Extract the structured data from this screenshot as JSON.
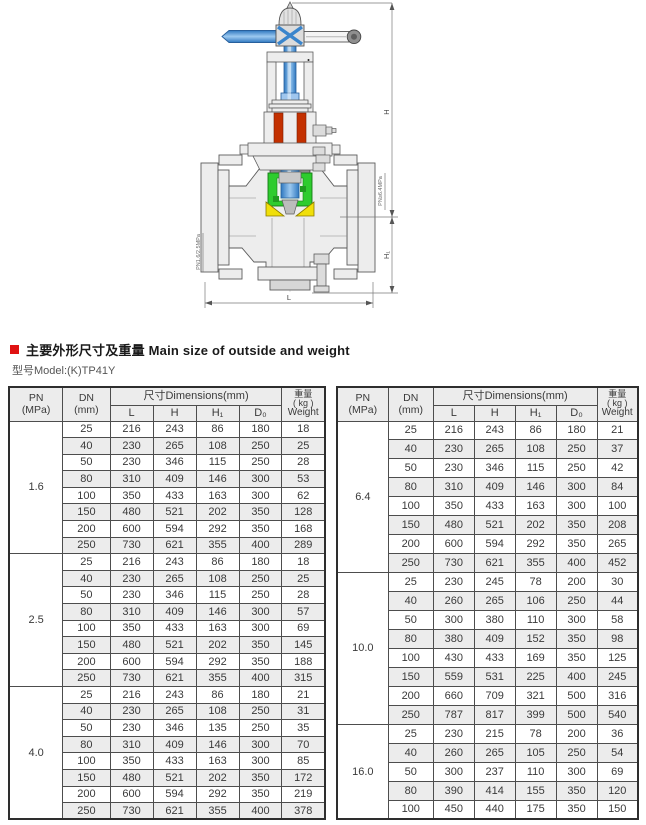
{
  "section": {
    "title_zh": "主要外形尺寸及重量",
    "title_en": "Main size of outside and weight",
    "model": "型号Model:(K)TP41Y"
  },
  "diagram": {
    "labels": {
      "h": "H",
      "h1": "H₁",
      "l": "L",
      "pn_left": "PN1.6/2.5MPa",
      "pn_right": "PN≥6.4MPa"
    },
    "colors": {
      "stem_blue": "#4a90d6",
      "cage_green": "#2ecc2e",
      "seat_yellow": "#f0df0a",
      "packing_red": "#c33000",
      "metal_gray": "#ededed"
    }
  },
  "table_headers": {
    "pn_1": "PN",
    "pn_2": "(MPa)",
    "dn_1": "DN",
    "dn_2": "(mm)",
    "dims": "尺寸Dimensions(mm)",
    "col_l": "L",
    "col_h": "H",
    "col_h1": "H₁",
    "col_d0": "D₀",
    "weight_1": "重量",
    "weight_2": "( kg )",
    "weight_3": "Weight"
  },
  "tables": [
    {
      "groups": [
        {
          "pn": "1.6",
          "rows": [
            [
              25,
              216,
              243,
              86,
              180,
              18
            ],
            [
              40,
              230,
              265,
              108,
              250,
              25
            ],
            [
              50,
              230,
              346,
              115,
              250,
              28
            ],
            [
              80,
              310,
              409,
              146,
              300,
              53
            ],
            [
              100,
              350,
              433,
              163,
              300,
              62
            ],
            [
              150,
              480,
              521,
              202,
              350,
              128
            ],
            [
              200,
              600,
              594,
              292,
              350,
              168
            ],
            [
              250,
              730,
              621,
              355,
              400,
              289
            ]
          ]
        },
        {
          "pn": "2.5",
          "rows": [
            [
              25,
              216,
              243,
              86,
              180,
              18
            ],
            [
              40,
              230,
              265,
              108,
              250,
              25
            ],
            [
              50,
              230,
              346,
              115,
              250,
              28
            ],
            [
              80,
              310,
              409,
              146,
              300,
              57
            ],
            [
              100,
              350,
              433,
              163,
              300,
              69
            ],
            [
              150,
              480,
              521,
              202,
              350,
              145
            ],
            [
              200,
              600,
              594,
              292,
              350,
              188
            ],
            [
              250,
              730,
              621,
              355,
              400,
              315
            ]
          ]
        },
        {
          "pn": "4.0",
          "rows": [
            [
              25,
              216,
              243,
              86,
              180,
              21
            ],
            [
              40,
              230,
              265,
              108,
              250,
              31
            ],
            [
              50,
              230,
              346,
              135,
              250,
              35
            ],
            [
              80,
              310,
              409,
              146,
              300,
              70
            ],
            [
              100,
              350,
              433,
              163,
              300,
              85
            ],
            [
              150,
              480,
              521,
              202,
              350,
              172
            ],
            [
              200,
              600,
              594,
              292,
              350,
              219
            ],
            [
              250,
              730,
              621,
              355,
              400,
              378
            ]
          ]
        }
      ]
    },
    {
      "groups": [
        {
          "pn": "6.4",
          "rows": [
            [
              25,
              216,
              243,
              86,
              180,
              21
            ],
            [
              40,
              230,
              265,
              108,
              250,
              37
            ],
            [
              50,
              230,
              346,
              115,
              250,
              42
            ],
            [
              80,
              310,
              409,
              146,
              300,
              84
            ],
            [
              100,
              350,
              433,
              163,
              300,
              100
            ],
            [
              150,
              480,
              521,
              202,
              350,
              208
            ],
            [
              200,
              600,
              594,
              292,
              350,
              265
            ],
            [
              250,
              730,
              621,
              355,
              400,
              452
            ]
          ]
        },
        {
          "pn": "10.0",
          "rows": [
            [
              25,
              230,
              245,
              78,
              200,
              30
            ],
            [
              40,
              260,
              265,
              106,
              250,
              44
            ],
            [
              50,
              300,
              380,
              110,
              300,
              58
            ],
            [
              80,
              380,
              409,
              152,
              350,
              98
            ],
            [
              100,
              430,
              433,
              169,
              350,
              125
            ],
            [
              150,
              559,
              531,
              225,
              400,
              245
            ],
            [
              200,
              660,
              709,
              321,
              500,
              316
            ],
            [
              250,
              787,
              817,
              399,
              500,
              540
            ]
          ]
        },
        {
          "pn": "16.0",
          "rows": [
            [
              25,
              230,
              215,
              78,
              200,
              36
            ],
            [
              40,
              260,
              265,
              105,
              250,
              54
            ],
            [
              50,
              300,
              237,
              110,
              300,
              69
            ],
            [
              80,
              390,
              414,
              155,
              350,
              120
            ],
            [
              100,
              450,
              440,
              175,
              350,
              150
            ]
          ]
        }
      ]
    }
  ]
}
